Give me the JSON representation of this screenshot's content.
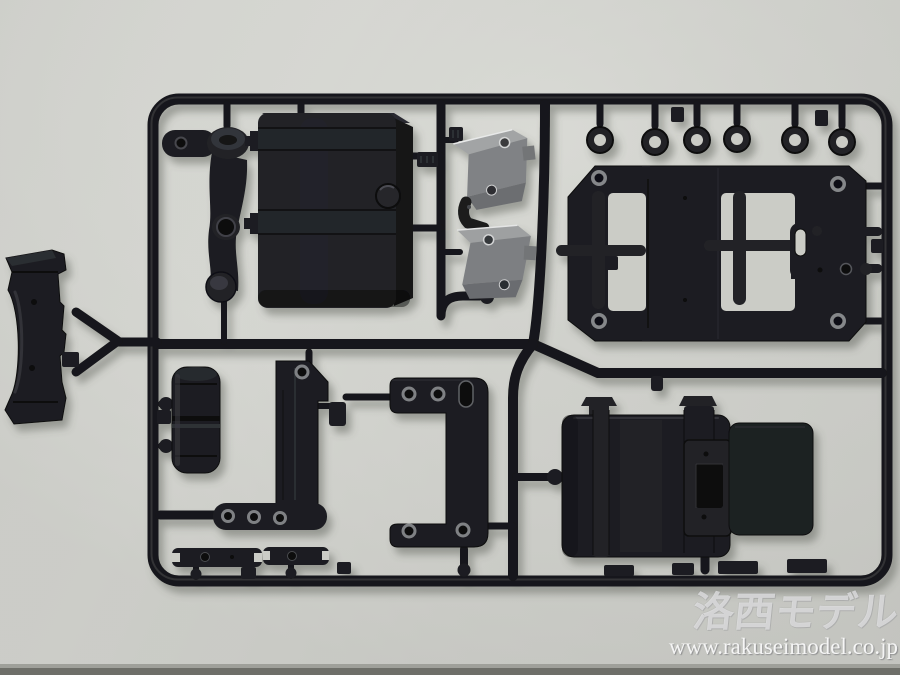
{
  "photo": {
    "subject": "Black plastic model-kit parts sprue (injection-molded runner) photographed on a light gray surface",
    "background_hex": "#cdcec9",
    "plastic_hex": "#1b1c1e",
    "gray_part_hex": "#85878a",
    "table_edge_hex": "#6e6f69"
  },
  "watermark": {
    "logo": "洛西モデル",
    "url": "www.rakuseimodel.co.jp"
  },
  "parts": [
    {
      "name": "cross-guard-part",
      "description": "bone-shaped guard plate outside frame, far left"
    },
    {
      "name": "steering-arm-part",
      "description": "curved bellcrank arm with bosses and holes, top left"
    },
    {
      "name": "fuel-tank-part",
      "description": "large strapped tank box with filler cap, top center-left"
    },
    {
      "name": "gray-bracket-parts",
      "description": "two light-gray step brackets with elbow piece, center"
    },
    {
      "name": "eyelet-parts",
      "description": "six ring eyelets hanging from top rail"
    },
    {
      "name": "frame-plate-part",
      "description": "large H-frame plate with corner holes, top right"
    },
    {
      "name": "hook-bracket-part",
      "description": "slotted hook bracket, right middle"
    },
    {
      "name": "cylinder-tank-part",
      "description": "ribbed air-tank cylinder, lower left"
    },
    {
      "name": "holey-plate-part",
      "description": "L-plate with row of holes, bottom center-left"
    },
    {
      "name": "c-plate-part",
      "description": "C-shaped bracket plate with holes and slot, bottom center"
    },
    {
      "name": "battery-box-part",
      "description": "large box with straps and connector panel, bottom right"
    },
    {
      "name": "flat-panel-part",
      "description": "flat rectangular panel beside battery box"
    },
    {
      "name": "link-bar-parts",
      "description": "two small forked link bars, bottom left"
    }
  ]
}
